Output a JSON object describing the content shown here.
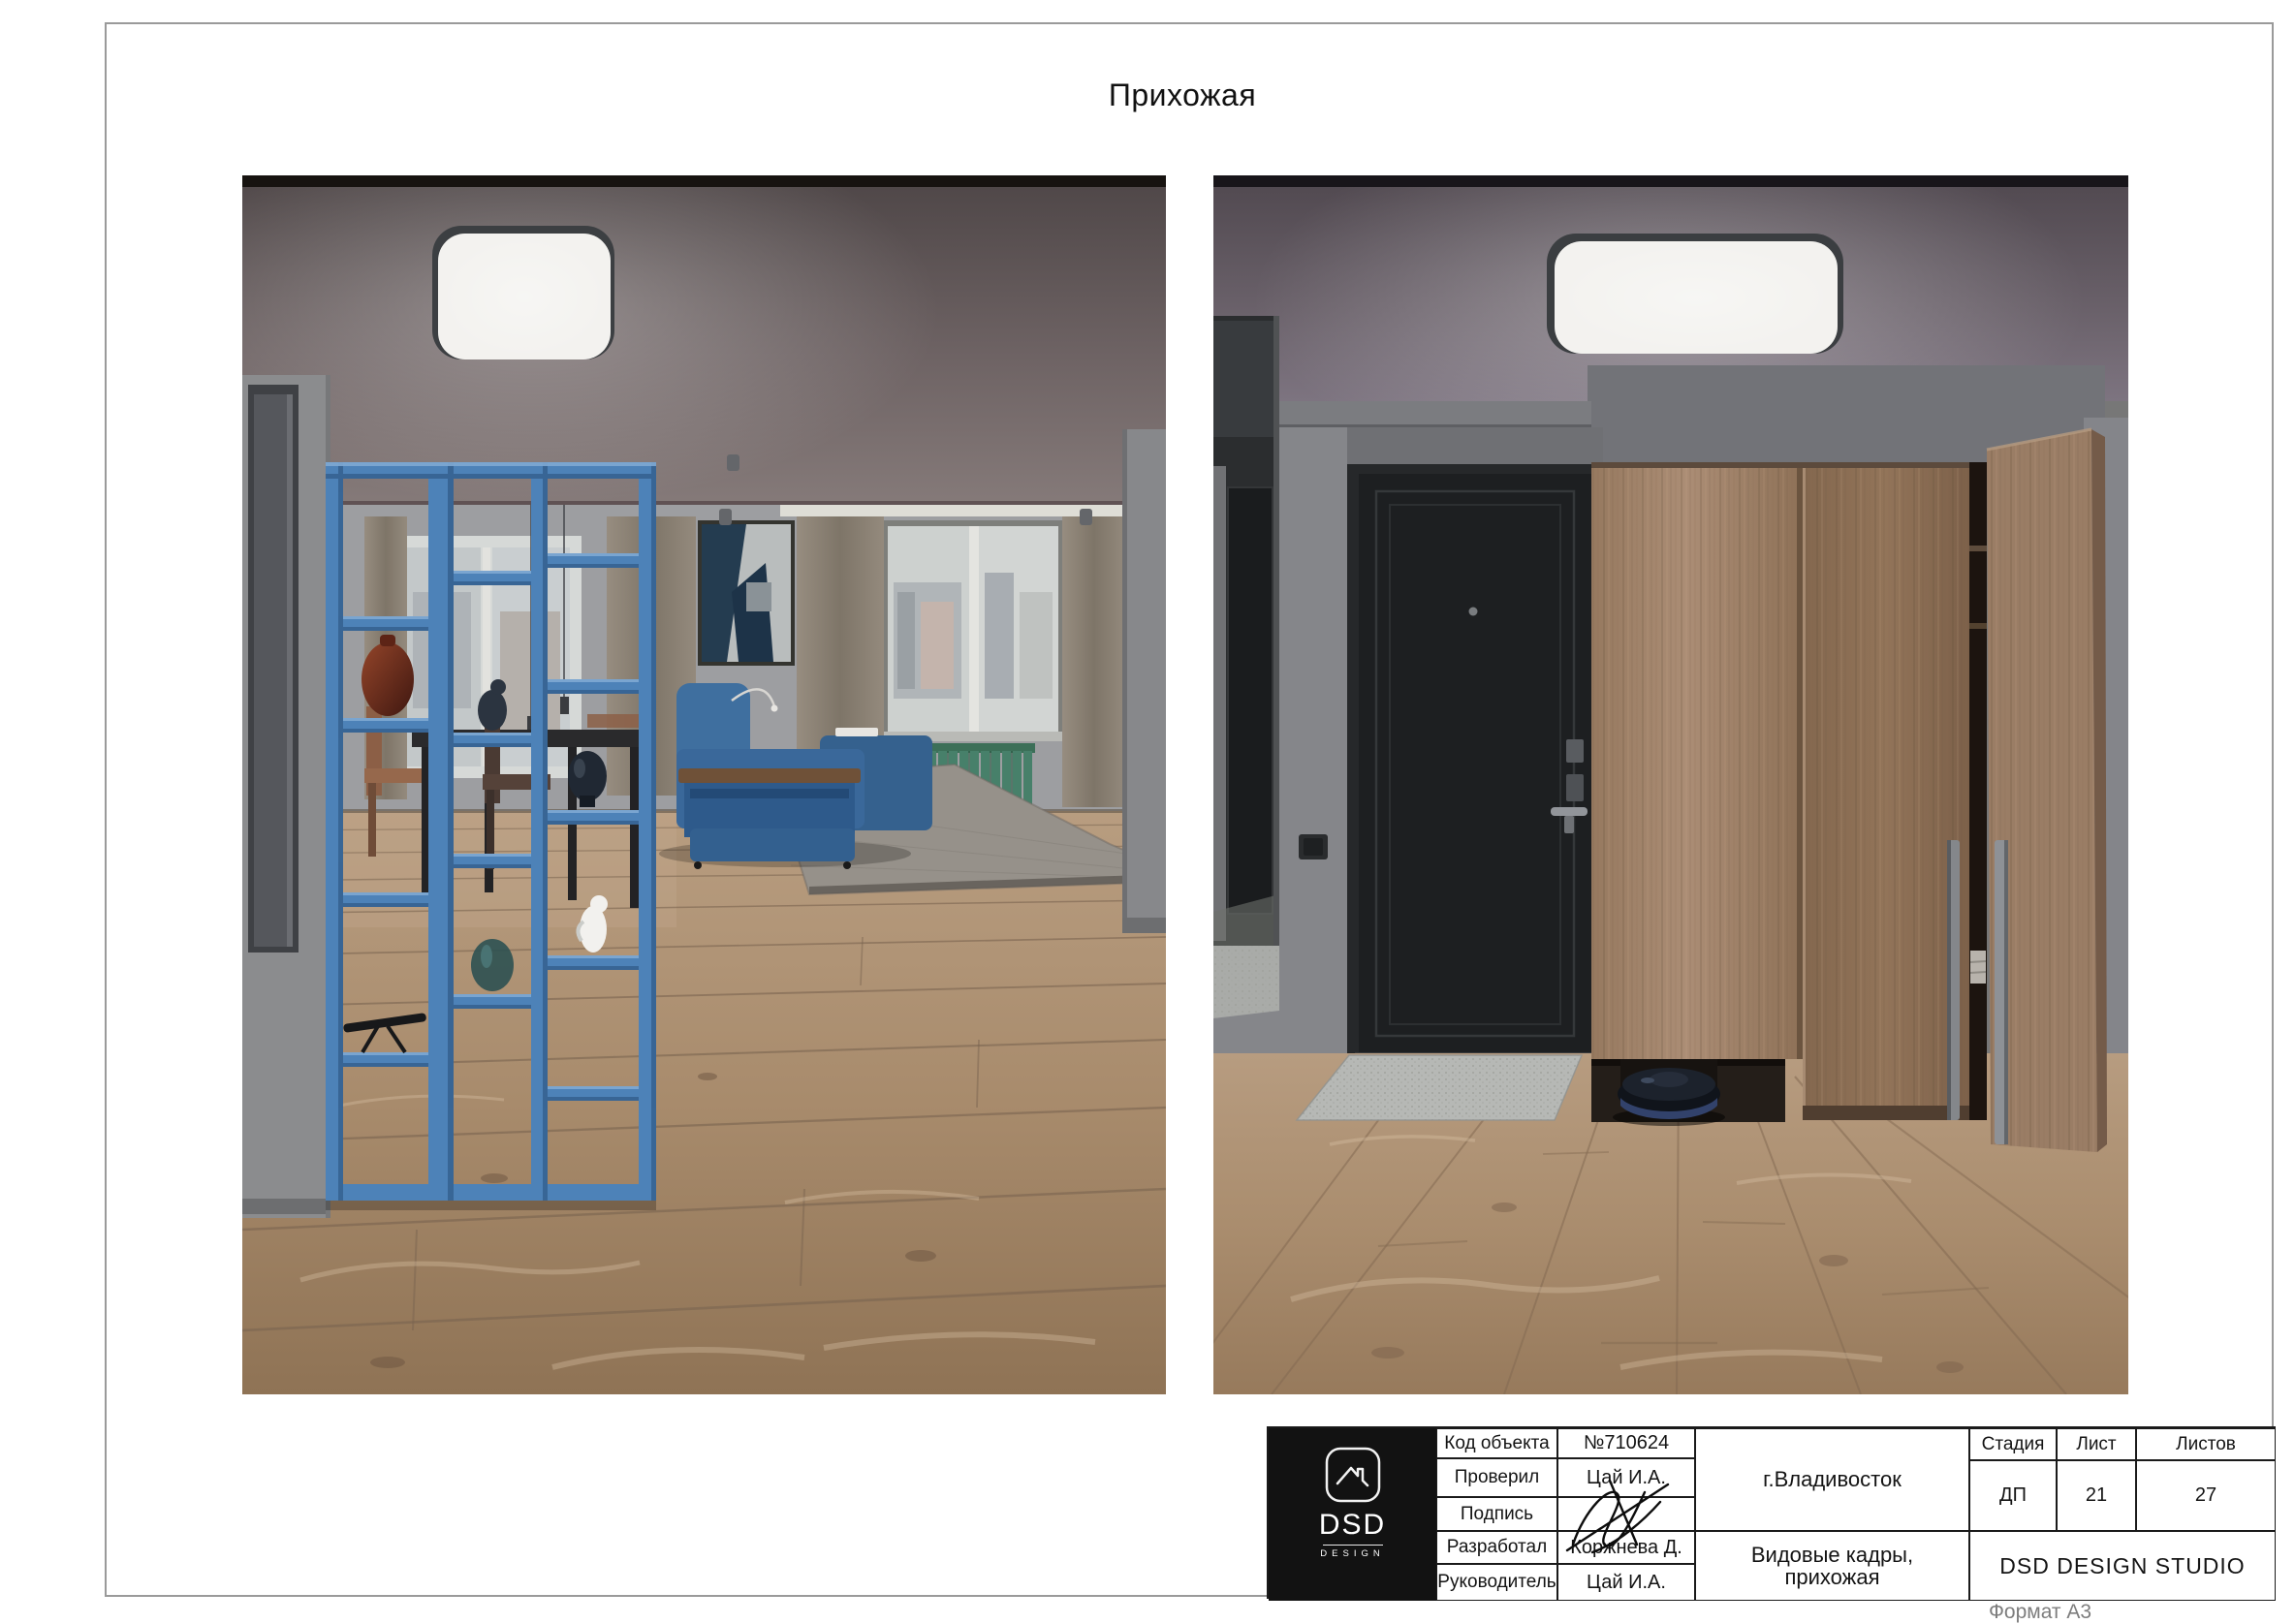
{
  "sheet": {
    "title": "Прихожая",
    "format_note": "Формат А3"
  },
  "stamp": {
    "logo": {
      "brand": "DSD",
      "subtitle": "DESIGN"
    },
    "rows": [
      {
        "label": "Код объекта",
        "value": "№710624"
      },
      {
        "label": "Проверил",
        "value": "Цай И.А."
      },
      {
        "label": "Подпись",
        "value": ""
      },
      {
        "label": "Разработал",
        "value": "Коржнева Д."
      },
      {
        "label": "Руководитель",
        "value": "Цай И.А."
      }
    ],
    "city": "г.Владивосток",
    "drawing_title": {
      "line1": "Видовые кадры,",
      "line2": "прихожая"
    },
    "studio": "DSD DESIGN STUDIO",
    "stage": {
      "label": "Стадия",
      "value": "ДП"
    },
    "sheet_no": {
      "label": "Лист",
      "value": "21"
    },
    "sheets_total": {
      "label": "Листов",
      "value": "27"
    }
  },
  "palette": {
    "frame_gray": "#9a9a9a",
    "stamp_black": "#121212",
    "accent_blue_shelf": "#4d82b8",
    "sofa_blue": "#3f6f9f",
    "radiator_green": "#47806a",
    "ceiling_mauve": "#6e6466",
    "wall_gray": "#8a8b8e",
    "wood_floor": "#b49879",
    "wardrobe_wood": "#a08069",
    "entry_door_black": "#1d1f21",
    "led_panel_white": "#f3f2ef"
  }
}
